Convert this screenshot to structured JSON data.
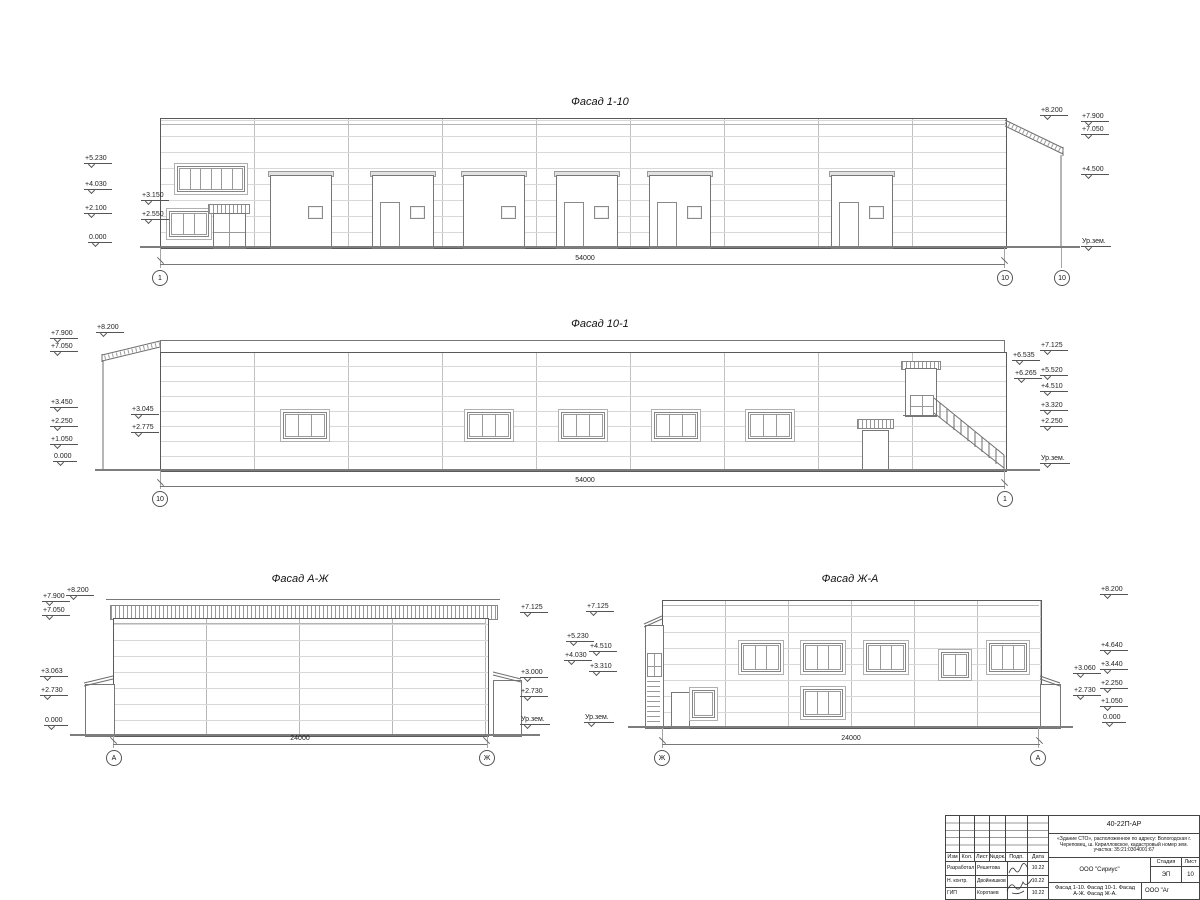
{
  "facades": [
    {
      "title": "Фасад 1-10",
      "dimension": "54000",
      "axes": [
        "1",
        "10",
        "10"
      ],
      "marks_left": [
        "+5.230",
        "+4.030",
        "+3.150",
        "+2.100",
        "+2.550",
        "0.000"
      ],
      "marks_right": [
        "+8.200",
        "+7.900",
        "+7.050",
        "+4.500",
        "Ур.зем."
      ]
    },
    {
      "title": "Фасад 10-1",
      "dimension": "54000",
      "axes": [
        "10",
        "1"
      ],
      "marks_left": [
        "+8.200",
        "+7.900",
        "+7.050",
        "+3.450",
        "+3.045",
        "+2.775",
        "+2.250",
        "+1.050",
        "0.000"
      ],
      "marks_right": [
        "+7.125",
        "+6.535",
        "+6.265",
        "+5.520",
        "+4.510",
        "+3.320",
        "+2.250",
        "Ур.зем."
      ]
    },
    {
      "title": "Фасад А-Ж",
      "dimension": "24000",
      "axes": [
        "А",
        "Ж"
      ],
      "marks_left": [
        "+8.200",
        "+7.900",
        "+7.050",
        "+3.063",
        "+2.730",
        "0.000"
      ],
      "marks_right": [
        "+7.125",
        "+3.000",
        "+2.730",
        "Ур.зем."
      ]
    },
    {
      "title": "Фасад Ж-А",
      "dimension": "24000",
      "axes": [
        "Ж",
        "А"
      ],
      "marks_left": [
        "+7.125",
        "+5.230",
        "+4.510",
        "+4.030",
        "+3.310",
        "Ур.зем."
      ],
      "marks_right": [
        "+8.200",
        "+4.640",
        "+3.440",
        "+3.060",
        "+2.730",
        "+2.250",
        "+1.050",
        "0.000"
      ]
    }
  ],
  "title_block": {
    "doc_number": "40-22П-АР",
    "project": "«Здание СТО», расположенное по адресу: Вологодская г. Череповец, ш. Кирилловское, кадастровый номер зем. участка: 35:21:0304001:67",
    "columns": [
      "Изм",
      "Кол.",
      "Лист",
      "№док.",
      "Подп.",
      "Дата"
    ],
    "rows": [
      {
        "role": "Разработал",
        "name": "Решетова",
        "date": "10.22"
      },
      {
        "role": "Н. контр.",
        "name": "Двойнишков",
        "date": "10.22"
      },
      {
        "role": "ГИП",
        "name": "Коротаев",
        "date": "10.22"
      }
    ],
    "company": "ООО \"Сириус\"",
    "stage_label": "Стадия",
    "stage": "ЭП",
    "sheet_label": "Лист",
    "sheet_number": "10",
    "content": "Фасад 1-10. Фасад 10-1. Фасад А-Ж. Фасад Ж-А.",
    "company2": "ООО \"Аг"
  }
}
